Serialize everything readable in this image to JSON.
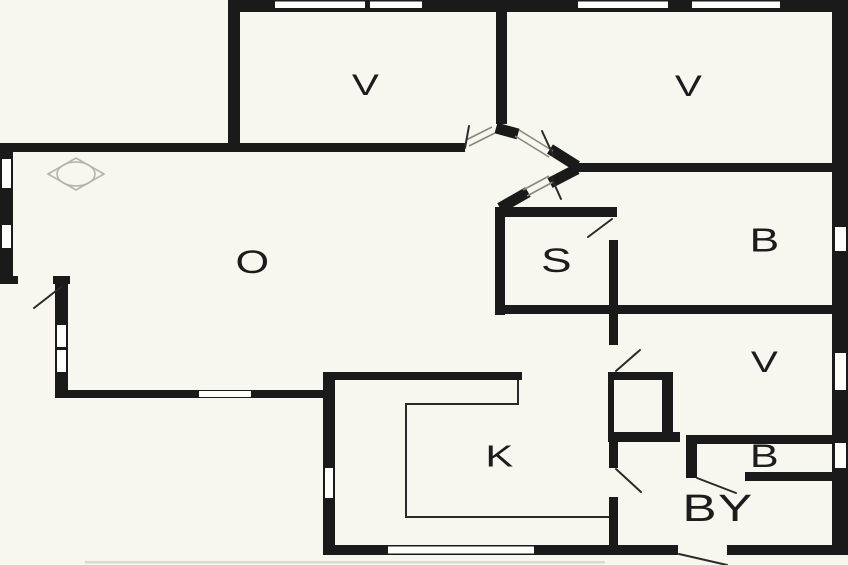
{
  "plan": {
    "title": "Apartment floor plan",
    "colors": {
      "wall": "#1a1a1a",
      "floor": "#f7f6ef",
      "window": "#fdfdfa",
      "opening_line": "#88887f",
      "thin_line": "#2a2a2a",
      "fixture": "#b4b4aa"
    },
    "rooms": [
      {
        "id": "bedroom-top-left",
        "label": "V"
      },
      {
        "id": "bedroom-top-right",
        "label": "V"
      },
      {
        "id": "living-room",
        "label": "O"
      },
      {
        "id": "closet-room",
        "label": "S"
      },
      {
        "id": "bedroom-right",
        "label": "B"
      },
      {
        "id": "bedroom-mid-right",
        "label": "V"
      },
      {
        "id": "kitchen",
        "label": "K"
      },
      {
        "id": "bathroom",
        "label": "B"
      },
      {
        "id": "utility-room",
        "label": "BY"
      }
    ],
    "icons": {
      "fixture_symbol": "diamond-ellipse-lamp"
    }
  }
}
